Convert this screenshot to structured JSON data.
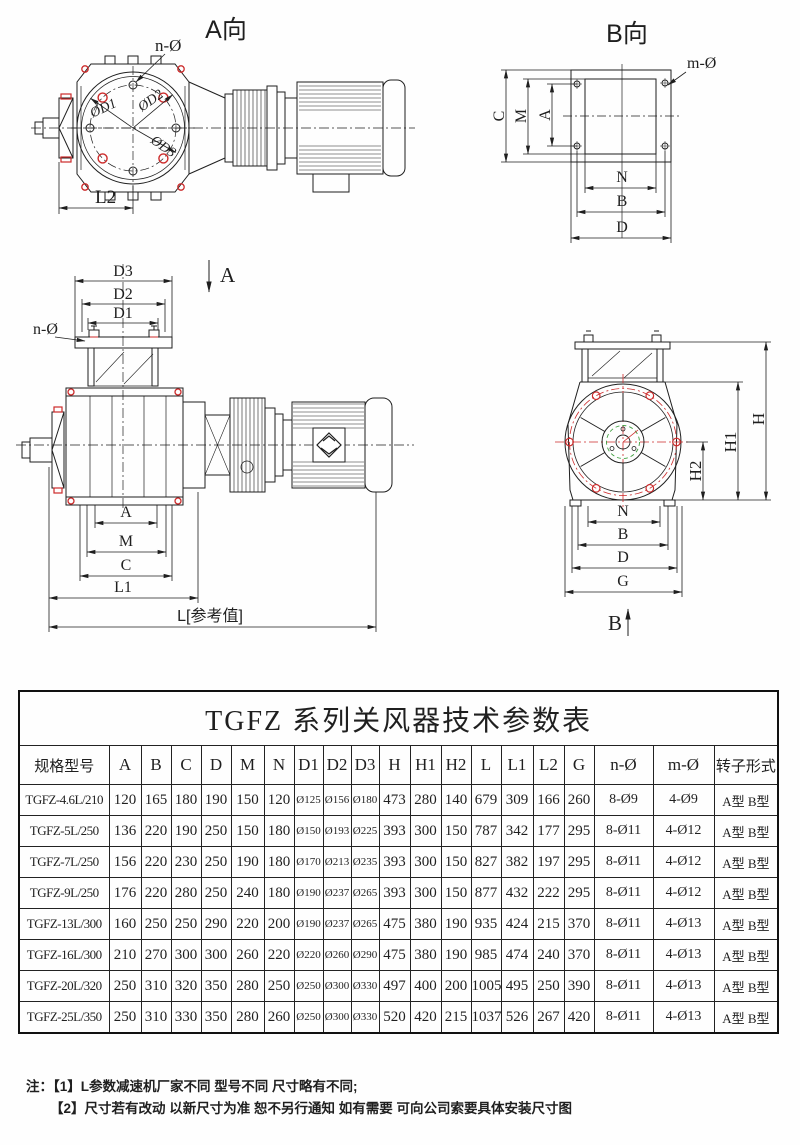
{
  "colors": {
    "ink": "#1f1f1f",
    "red": "#cc2a2a",
    "green": "#3f9e3f"
  },
  "views": {
    "a": {
      "title": "A向",
      "n_hole": "n-Ø",
      "d1": "ØD1",
      "d2": "ØD2",
      "d3": "ØD3",
      "l2": "L2"
    },
    "b": {
      "title": "B向",
      "m_hole": "m-Ø",
      "c": "C",
      "m": "M",
      "a": "A",
      "n": "N",
      "b": "B",
      "d": "D"
    },
    "front": {
      "d3": "D3",
      "d2": "D2",
      "d1": "D1",
      "n_hole": "n-Ø",
      "section": "A",
      "a": "A",
      "m": "M",
      "c": "C",
      "l1": "L1",
      "l_ref": "L[参考值]"
    },
    "side": {
      "h": "H",
      "h1": "H1",
      "h2": "H2",
      "n": "N",
      "b": "B",
      "d": "D",
      "g": "G",
      "section": "B"
    }
  },
  "table": {
    "title": "TGFZ 系列关风器技术参数表",
    "headers": [
      "规格型号",
      "A",
      "B",
      "C",
      "D",
      "M",
      "N",
      "D1",
      "D2",
      "D3",
      "H",
      "H1",
      "H2",
      "L",
      "L1",
      "L2",
      "G",
      "n-Ø",
      "m-Ø",
      "转子形式"
    ],
    "rows": [
      [
        "TGFZ-4.6L/210",
        "120",
        "165",
        "180",
        "190",
        "150",
        "120",
        "Ø125",
        "Ø156",
        "Ø180",
        "473",
        "280",
        "140",
        "679",
        "309",
        "166",
        "260",
        "8-Ø9",
        "4-Ø9",
        "A型 B型"
      ],
      [
        "TGFZ-5L/250",
        "136",
        "220",
        "190",
        "250",
        "150",
        "180",
        "Ø150",
        "Ø193",
        "Ø225",
        "393",
        "300",
        "150",
        "787",
        "342",
        "177",
        "295",
        "8-Ø11",
        "4-Ø12",
        "A型 B型"
      ],
      [
        "TGFZ-7L/250",
        "156",
        "220",
        "230",
        "250",
        "190",
        "180",
        "Ø170",
        "Ø213",
        "Ø235",
        "393",
        "300",
        "150",
        "827",
        "382",
        "197",
        "295",
        "8-Ø11",
        "4-Ø12",
        "A型 B型"
      ],
      [
        "TGFZ-9L/250",
        "176",
        "220",
        "280",
        "250",
        "240",
        "180",
        "Ø190",
        "Ø237",
        "Ø265",
        "393",
        "300",
        "150",
        "877",
        "432",
        "222",
        "295",
        "8-Ø11",
        "4-Ø12",
        "A型 B型"
      ],
      [
        "TGFZ-13L/300",
        "160",
        "250",
        "250",
        "290",
        "220",
        "200",
        "Ø190",
        "Ø237",
        "Ø265",
        "475",
        "380",
        "190",
        "935",
        "424",
        "215",
        "370",
        "8-Ø11",
        "4-Ø13",
        "A型 B型"
      ],
      [
        "TGFZ-16L/300",
        "210",
        "270",
        "300",
        "300",
        "260",
        "220",
        "Ø220",
        "Ø260",
        "Ø290",
        "475",
        "380",
        "190",
        "985",
        "474",
        "240",
        "370",
        "8-Ø11",
        "4-Ø13",
        "A型 B型"
      ],
      [
        "TGFZ-20L/320",
        "250",
        "310",
        "320",
        "350",
        "280",
        "250",
        "Ø250",
        "Ø300",
        "Ø330",
        "497",
        "400",
        "200",
        "1005",
        "495",
        "250",
        "390",
        "8-Ø11",
        "4-Ø13",
        "A型 B型"
      ],
      [
        "TGFZ-25L/350",
        "250",
        "310",
        "330",
        "350",
        "280",
        "260",
        "Ø250",
        "Ø300",
        "Ø330",
        "520",
        "420",
        "215",
        "1037",
        "526",
        "267",
        "420",
        "8-Ø11",
        "4-Ø13",
        "A型 B型"
      ]
    ]
  },
  "notes": {
    "prefix": "注：",
    "line1": "【1】L参数减速机厂家不同 型号不同 尺寸略有不同;",
    "line2": "【2】尺寸若有改动 以新尺寸为准 恕不另行通知 如有需要 可向公司索要具体安装尺寸图"
  }
}
